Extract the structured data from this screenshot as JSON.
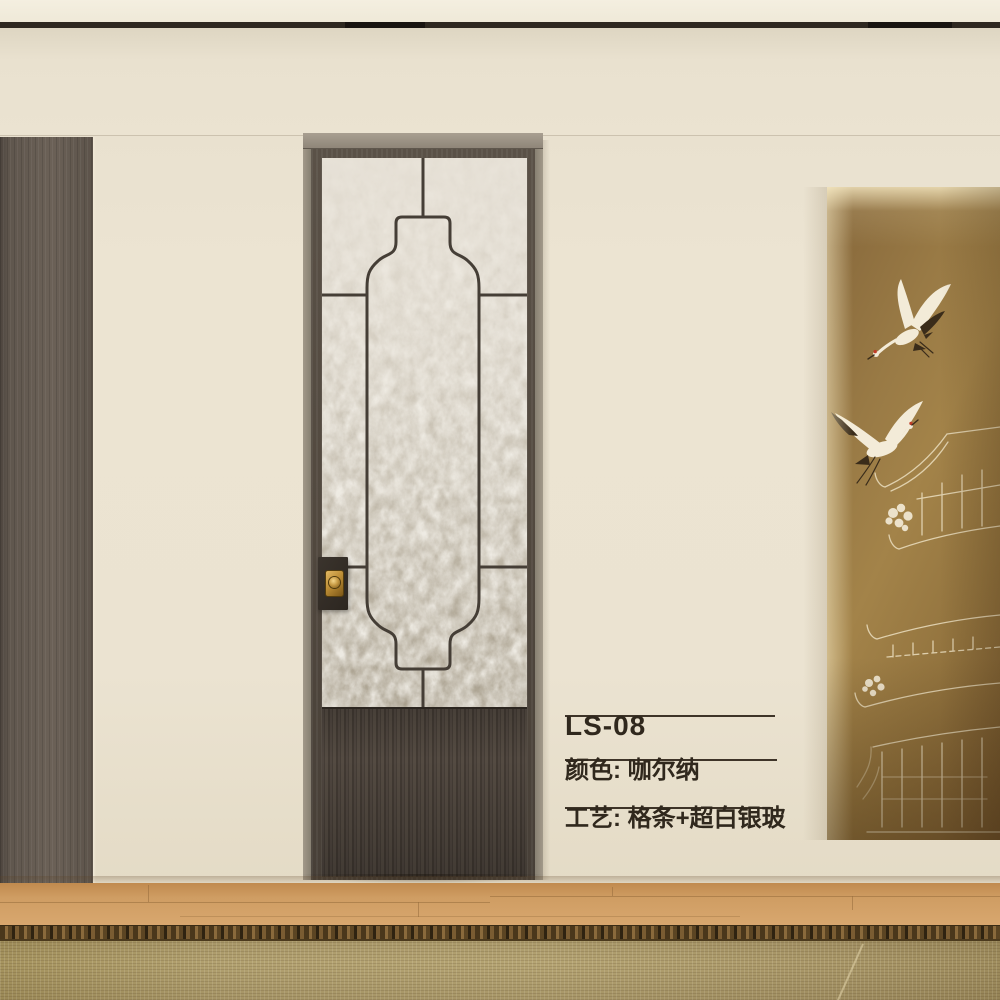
{
  "product": {
    "model": "LS-08",
    "color": "颜色: 咖尔纳",
    "craft": "工艺: 格条+超白银玻"
  },
  "colors": {
    "wall": "#ebe3d1",
    "ceiling": "#f2ecdc",
    "ceiling_slot": "#2e2820",
    "left_panel_wood": "#6a5f55",
    "door_frame": "#52493f",
    "door_casing": "#99907f",
    "door_lower_panel": "#453d36",
    "glass": "#c9c2b4",
    "glass_grid": "#453e36",
    "handle_brass": "#bd8e36",
    "niche_background": "#977741",
    "crane_body": "#f3ebd8",
    "crane_dark_feathers": "#3a2c1a",
    "crane_crown_red": "#bf3c28",
    "mural_line_art": "#f0e5c8",
    "floor_wood": "#cf9d63",
    "rug": "#b2a170",
    "rug_border": "#4a371b",
    "label_text": "#30281d"
  },
  "motifs": {
    "glass_pattern": "lantern-grid",
    "mural": [
      "flying-crane",
      "flying-crane",
      "pagoda-pavilion",
      "peony-flowers"
    ]
  }
}
